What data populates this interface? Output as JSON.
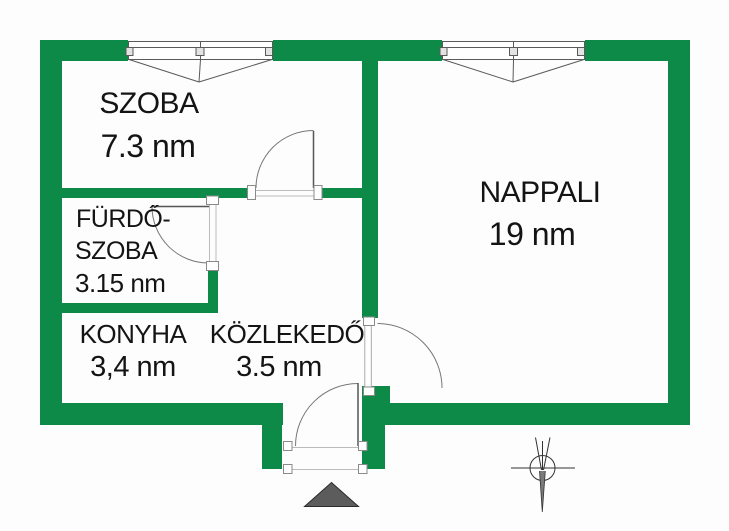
{
  "plan_title": "apartment-floor-plan",
  "rooms": {
    "szoba": {
      "name": "SZOBA",
      "area": "7.3 nm"
    },
    "nappali": {
      "name": "NAPPALI",
      "area": "19 nm"
    },
    "furdoszoba": {
      "name_line1": "FÜRDŐ-",
      "name_line2": "SZOBA",
      "area": "3.15 nm"
    },
    "konyha": {
      "name": "KONYHA",
      "area": "3,4 nm"
    },
    "kozlekedo": {
      "name": "KÖZLEKEDŐ",
      "area": "3.5 nm"
    }
  },
  "colors": {
    "wall": "#0e8a48",
    "background": "#fdfdfd",
    "text": "#141414",
    "symbol_line": "#555555",
    "entrance_marker": "#5c5c5c"
  }
}
